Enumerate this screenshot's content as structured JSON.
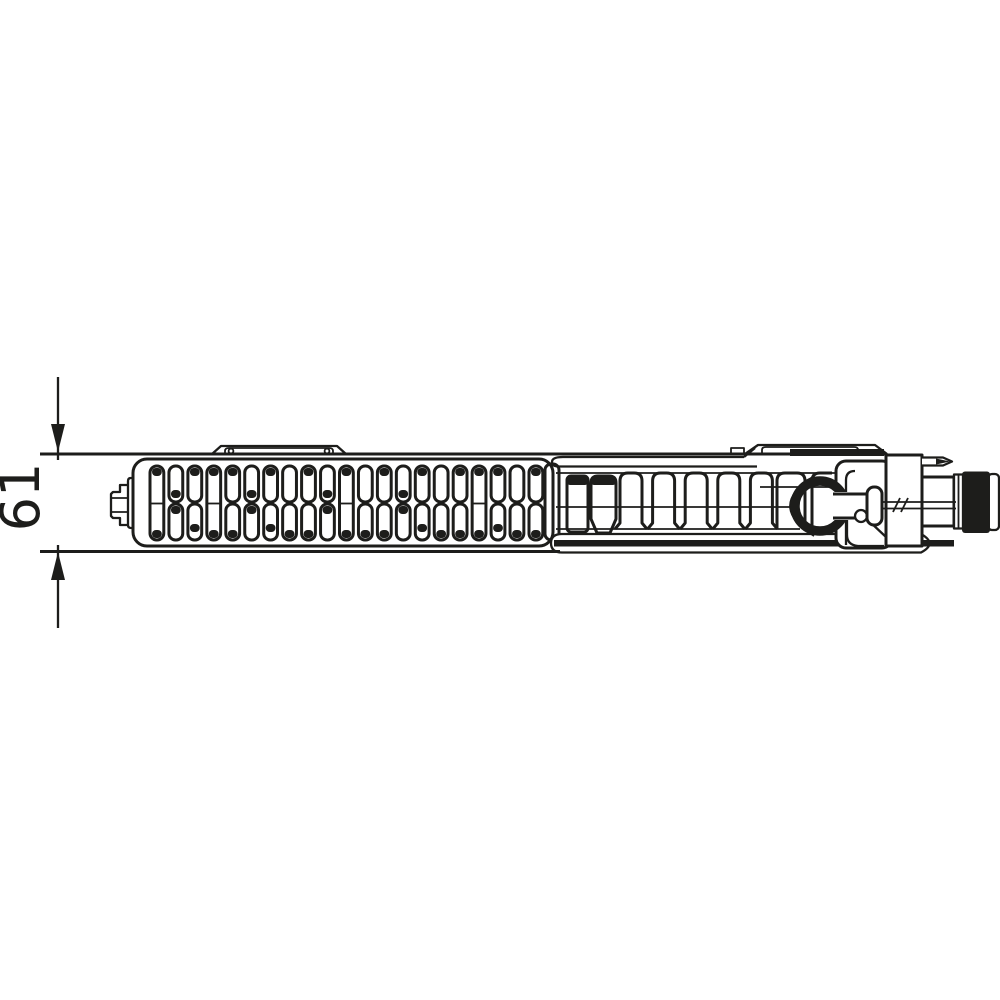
{
  "page": {
    "background": "#ffffff",
    "ink": "#1d1d1b"
  },
  "dimension": {
    "label": "61"
  },
  "drawing": {
    "kind": "radiator-top-view-technical-drawing",
    "grille_slot_columns": 21,
    "convector_fin_count": 5,
    "thermostat_cap_fill": "#1d1d1b"
  }
}
